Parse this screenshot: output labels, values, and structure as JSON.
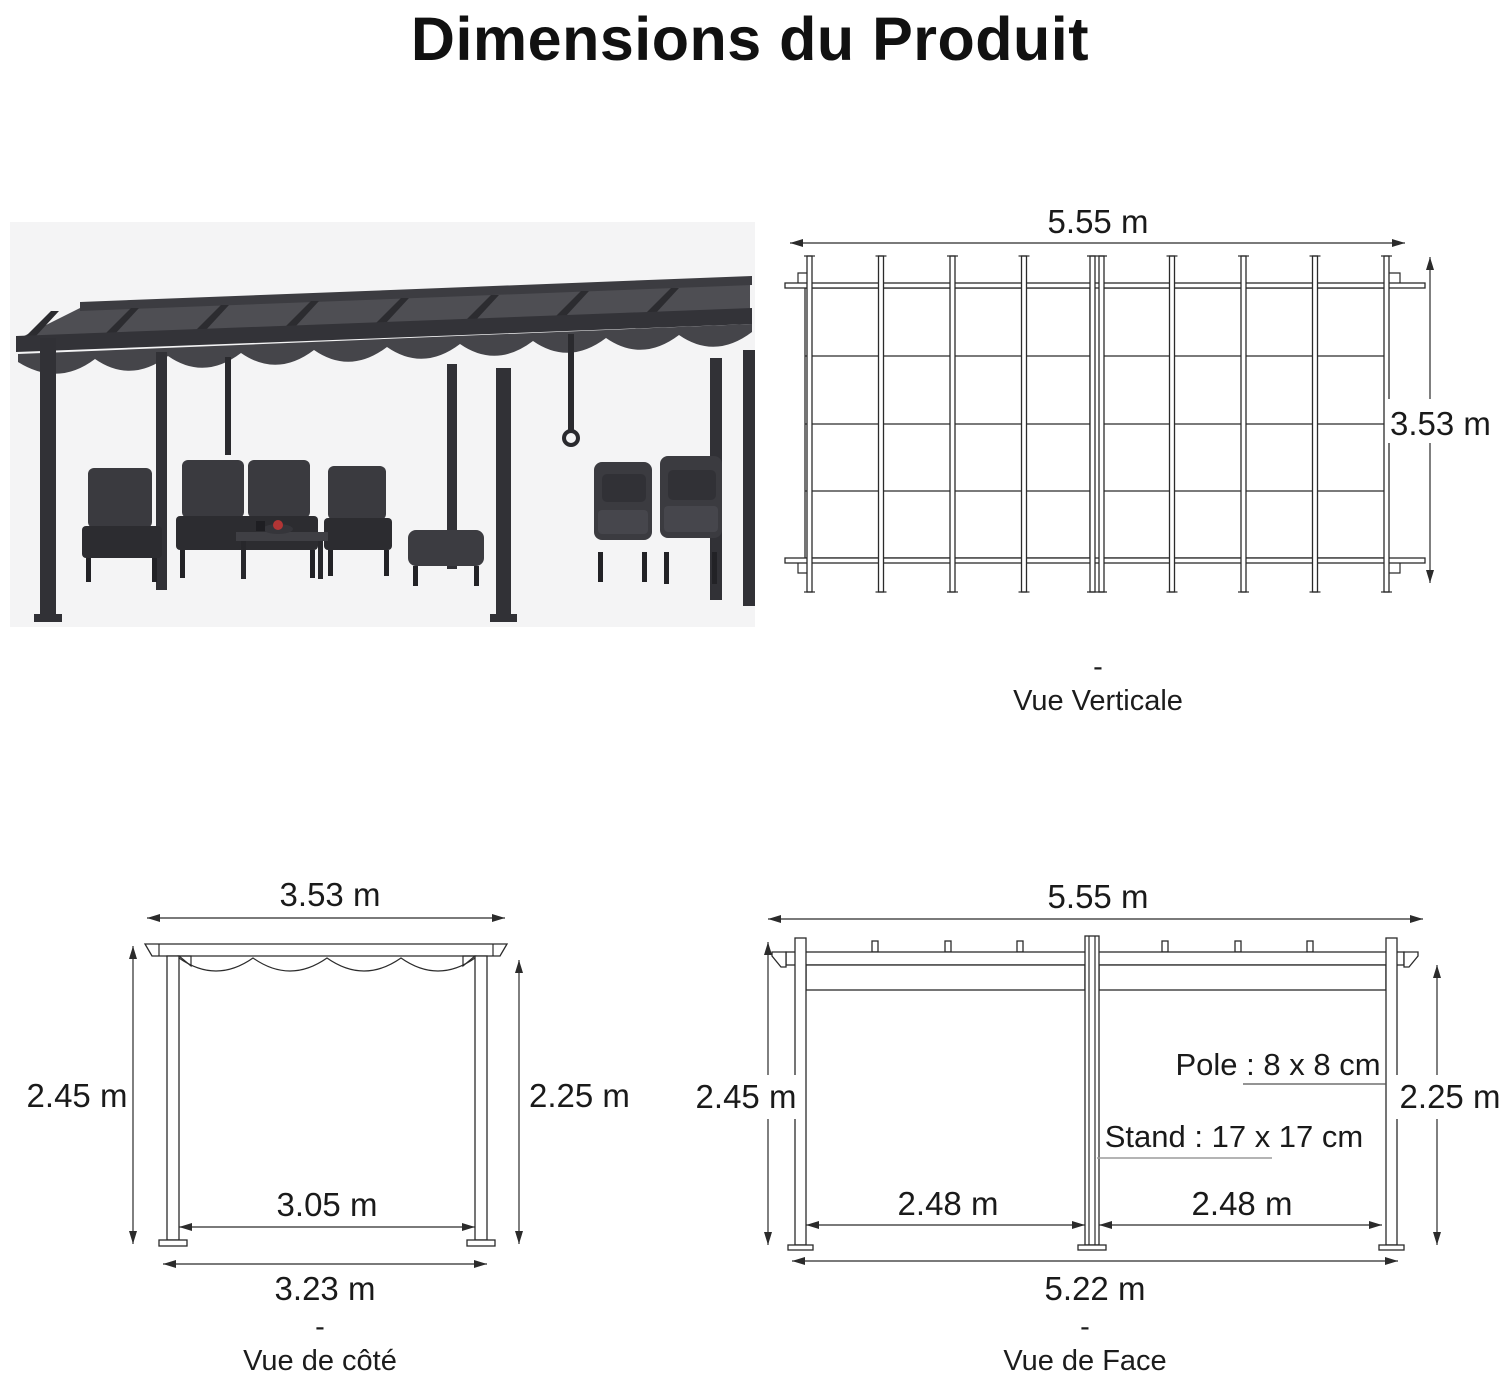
{
  "title": "Dimensions du Produit",
  "views": {
    "top": {
      "dash": "-",
      "caption": "Vue Verticale",
      "width_label": "5.55 m",
      "depth_label": "3.53 m"
    },
    "side": {
      "dash": "-",
      "caption": "Vue de côté",
      "top_label": "3.53 m",
      "left_label": "2.45 m",
      "right_label": "2.25 m",
      "inner_label": "3.05 m",
      "base_label": "3.23 m"
    },
    "front": {
      "dash": "-",
      "caption": "Vue de Face",
      "top_label": "5.55 m",
      "left_label": "2.45 m",
      "right_label": "2.25 m",
      "pole_label": "Pole : 8 x 8 cm",
      "stand_label": "Stand : 17 x 17 cm",
      "bay_left_label": "2.48 m",
      "bay_right_label": "2.48 m",
      "base_label": "5.22 m"
    }
  },
  "colors": {
    "text": "#1a1a1a",
    "line": "#2b2b2b",
    "photo_background": "#f4f4f5",
    "pergola_frame": "#333338",
    "canopy": "#47474c",
    "accent_red": "#b23535",
    "stand_underline": "#9b9b9b"
  }
}
